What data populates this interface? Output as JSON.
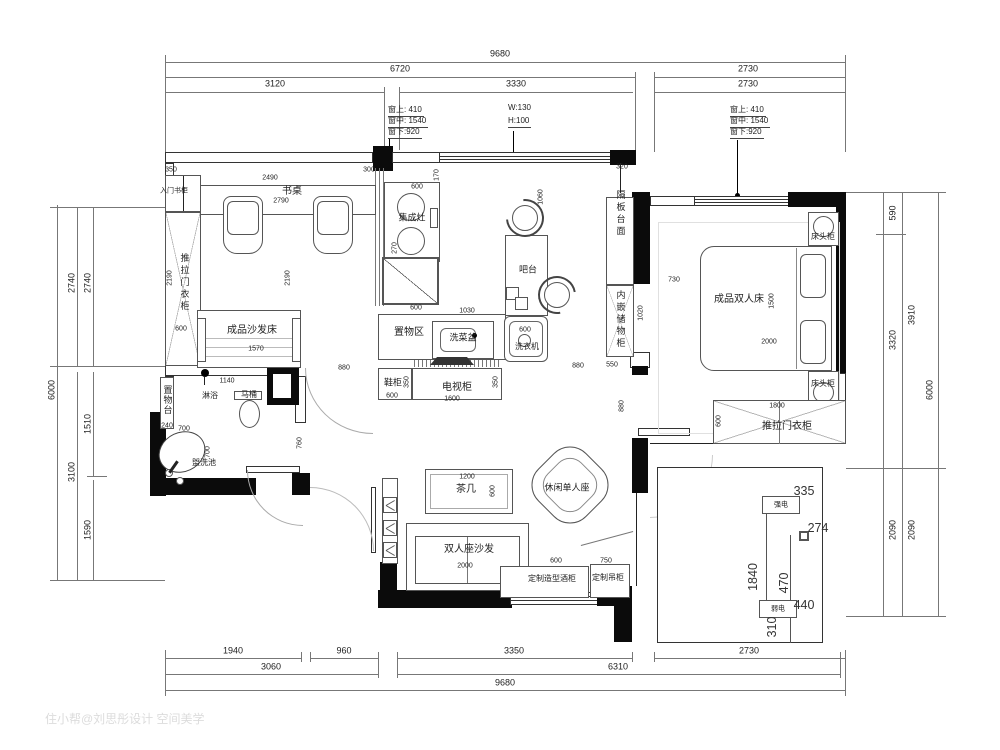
{
  "watermark": "住小帮@刘思彤设计 空间美学",
  "annotations": {
    "window_left": [
      "窗上: 410",
      "窗中: 1540",
      "窗下:920"
    ],
    "beam": [
      "W:130",
      "H:100"
    ],
    "window_right": [
      "窗上: 410",
      "窗中: 1540",
      "窗下:920"
    ]
  },
  "dims": {
    "top": {
      "d9680": "9680",
      "d6720": "6720",
      "d2730a": "2730",
      "d3120": "3120",
      "d3330": "3330",
      "d2730b": "2730"
    },
    "bottom": {
      "d1940": "1940",
      "d960": "960",
      "d3350": "3350",
      "d2730": "2730",
      "d3060": "3060",
      "d6310": "6310",
      "d9680": "9680"
    },
    "left": {
      "d6000": "6000",
      "d2740a": "2740",
      "d3100": "3100",
      "d2740b": "2740",
      "d1510": "1510",
      "d1590": "1590"
    },
    "right": {
      "d590": "590",
      "d3320": "3320",
      "d2090a": "2090",
      "d3910": "3910",
      "d2090b": "2090",
      "d6000": "6000"
    }
  },
  "m": {
    "k01": "350",
    "k02": "2490",
    "k03": "2790",
    "k04": "300",
    "k05": "170",
    "k06": "2190",
    "k07": "2190",
    "k08": "600",
    "k09": "1570",
    "k10": "880",
    "k11": "600",
    "k12": "270",
    "k13": "320",
    "k14": "1060",
    "k15": "1030",
    "k16": "600",
    "k17": "600",
    "k18": "1020",
    "k19": "550",
    "k20": "880",
    "k21": "880",
    "k22": "600",
    "k23": "350",
    "k24": "1600",
    "k25": "350",
    "k26": "730",
    "k27": "1500",
    "k28": "2000",
    "k29": "1800",
    "k30": "600",
    "k31": "1200",
    "k32": "600",
    "k33": "2000",
    "k34": "600",
    "k35": "750",
    "k36": "1140",
    "k37": "240",
    "k38": "700",
    "k39": "700",
    "k40": "760",
    "k41": "335",
    "k42": "274",
    "k43": "1840",
    "k44": "470",
    "k45": "440",
    "k46": "310"
  },
  "rooms": {
    "entry_bookcase": "入门书柜",
    "desk": "书桌",
    "study_wardrobe": "推拉门衣柜",
    "sofa_bed": "成品沙发床",
    "stove": "集成灶",
    "storage_zone": "置物区",
    "sink": "洗菜盆",
    "washer": "洗衣机",
    "bar": "吧台",
    "shelf_counter": "隔板台面",
    "builtin_storage": "内嵌储物柜",
    "shoe_cabinet": "鞋柜",
    "tv_cabinet": "电视柜",
    "double_bed": "成品双人床",
    "nightstand": "床头柜",
    "bedroom_wardrobe": "推拉门衣柜",
    "tea_table": "茶几",
    "single_seat": "休闲单人座",
    "sofa": "双人座沙发",
    "wine_cabinet": "定制造型酒柜",
    "hanging_cabinet": "定制吊柜",
    "shelf_stand": "置物台",
    "shower": "淋浴",
    "toilet": "马桶",
    "wash_basin": "盥洗池",
    "strong_elec": "强电",
    "weak_elec": "弱电"
  }
}
